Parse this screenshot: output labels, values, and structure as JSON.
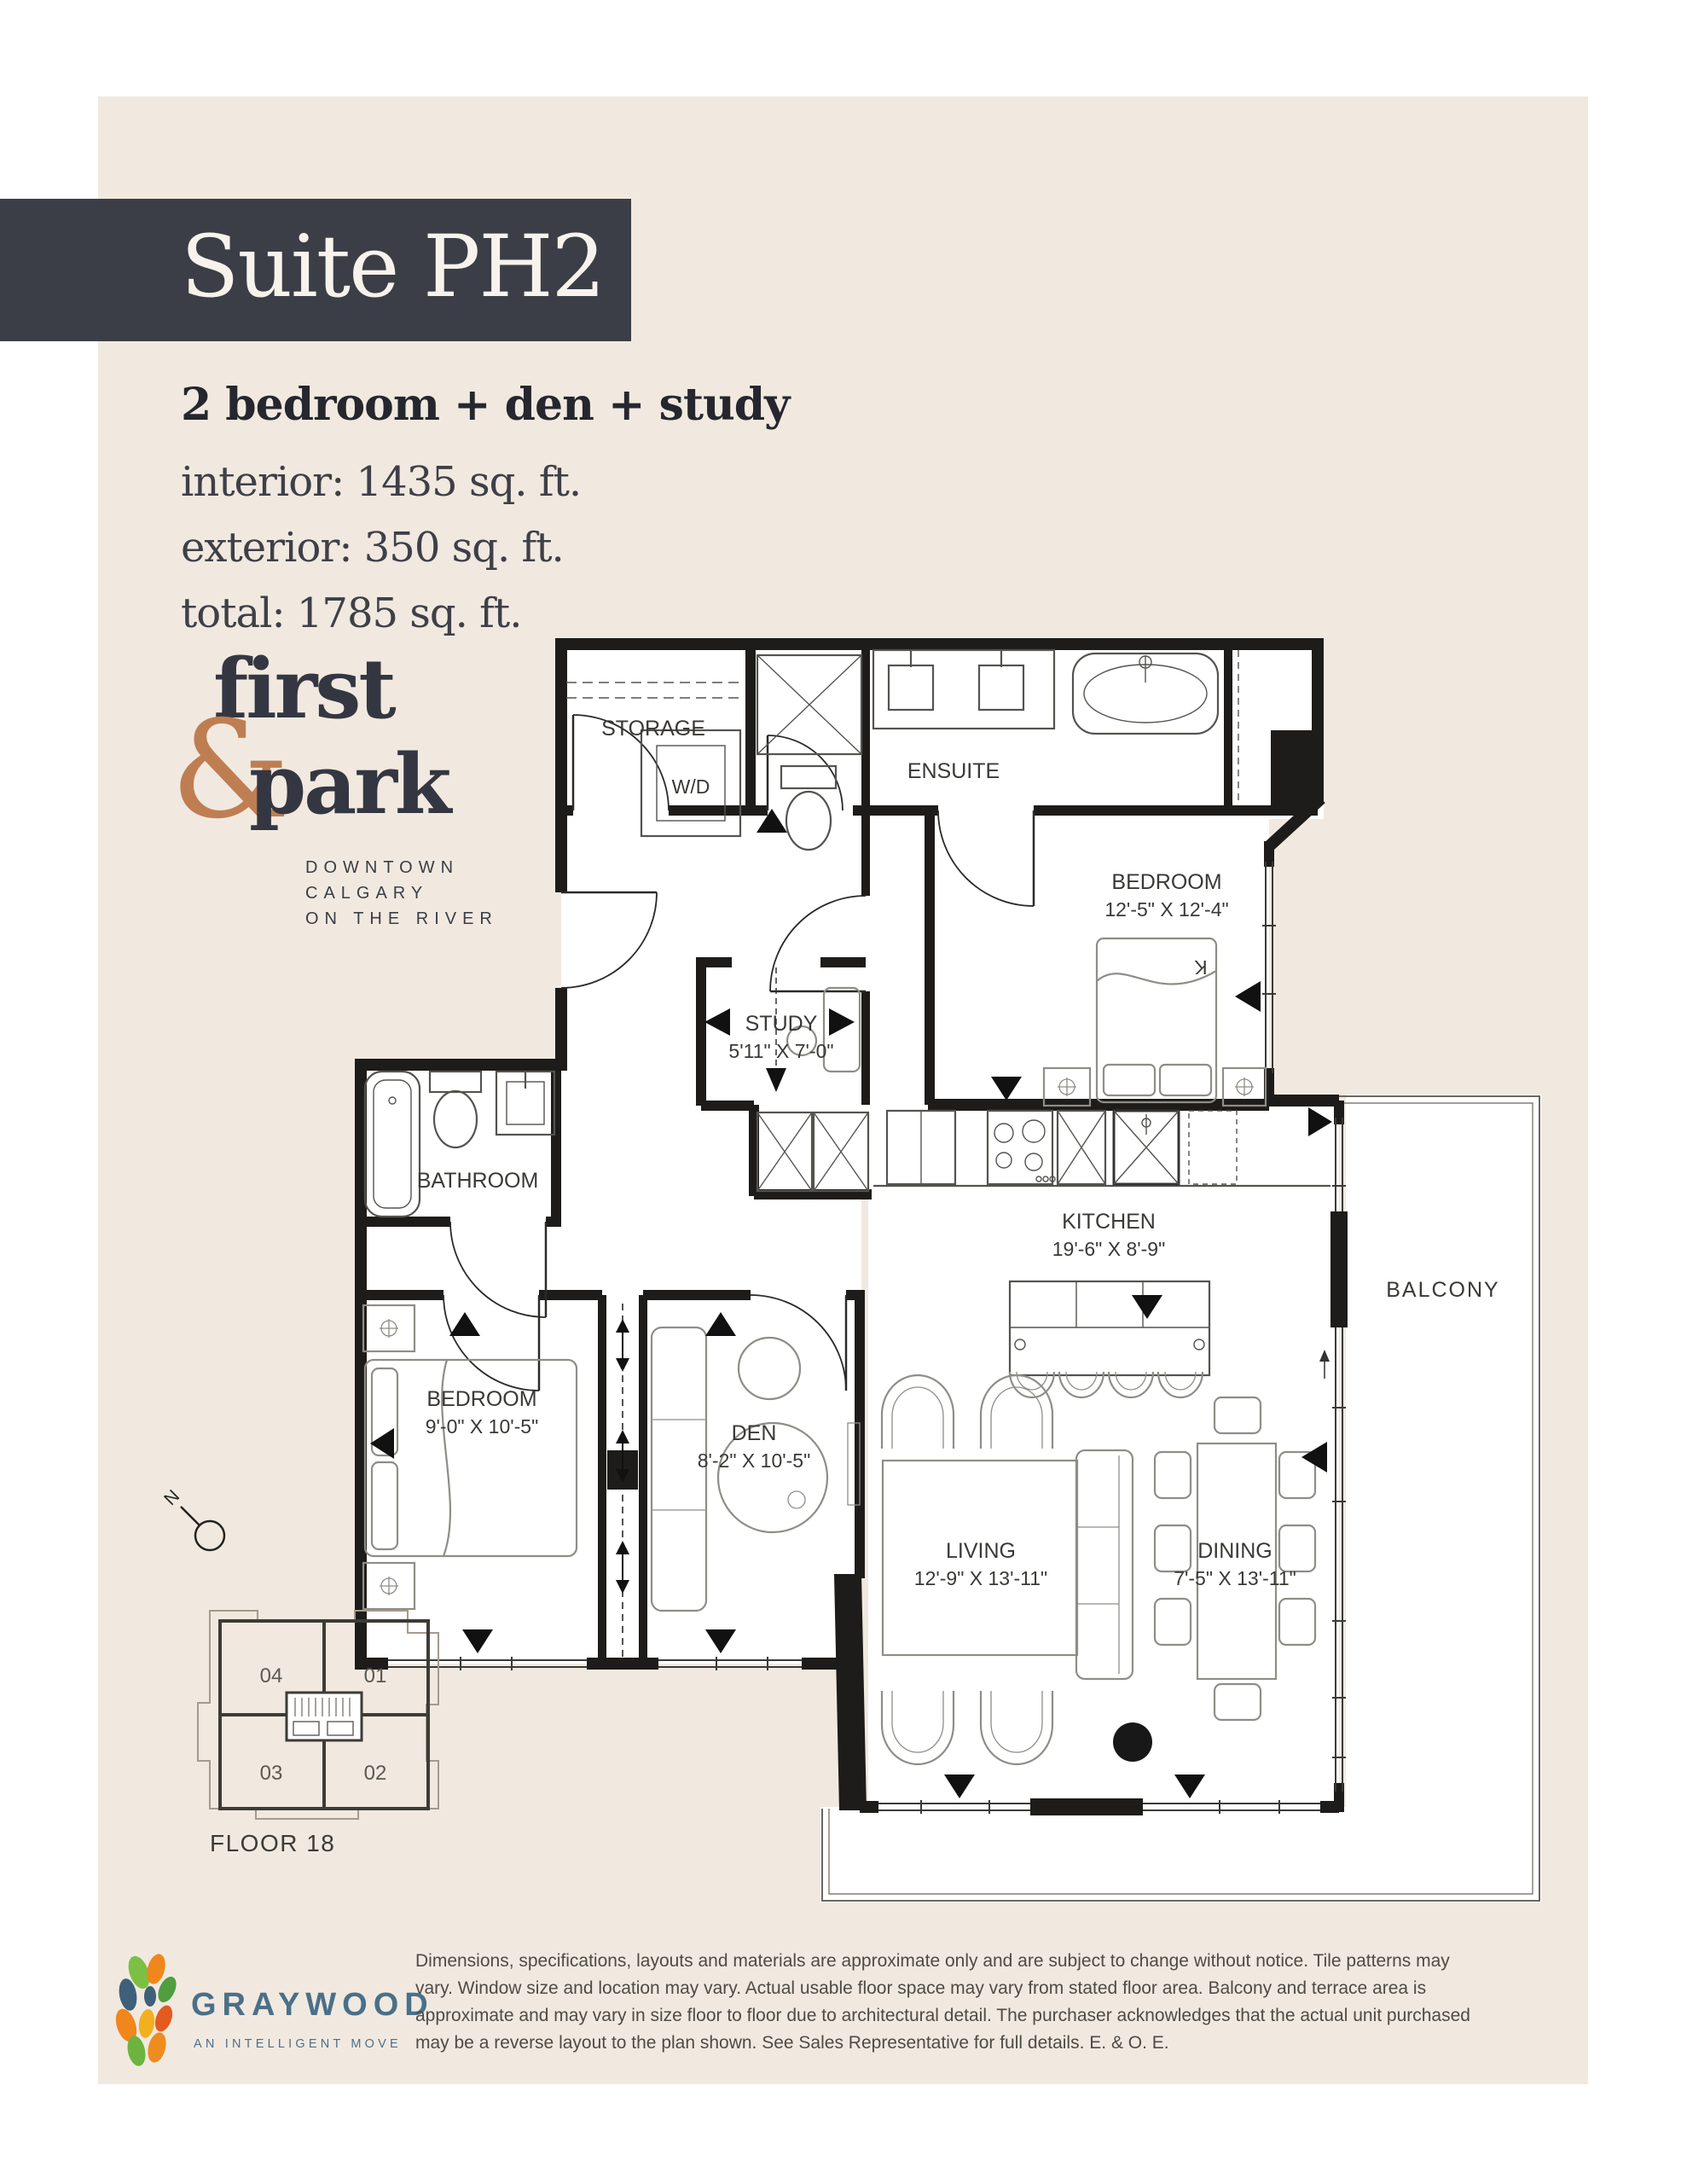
{
  "header": {
    "suite_title": "Suite PH2",
    "unit_type": "2 bedroom + den + study",
    "interior": "interior: 1435 sq. ft.",
    "exterior": "exterior: 350 sq. ft.",
    "total": "total: 1785 sq. ft."
  },
  "brand": {
    "word1": "first",
    "ampersand": "&",
    "word2": "park",
    "tagline_line1": "DOWNTOWN",
    "tagline_line2": "CALGARY",
    "tagline_line3": "ON THE RIVER"
  },
  "floorplan": {
    "rooms": [
      {
        "name": "BEDROOM",
        "dims": "12'-5\" X 12'-4\""
      },
      {
        "name": "STUDY",
        "dims": "5'11\" X 7'-0\""
      },
      {
        "name": "BATHROOM",
        "dims": ""
      },
      {
        "name": "BEDROOM",
        "dims": "9'-0\" X 10'-5\""
      },
      {
        "name": "DEN",
        "dims": "8'-2\" X 10'-5\""
      },
      {
        "name": "KITCHEN",
        "dims": "19'-6\" X 8'-9\""
      },
      {
        "name": "LIVING",
        "dims": "12'-9\" X 13'-11\""
      },
      {
        "name": "DINING",
        "dims": "7'-5\" X 13'-11\""
      }
    ],
    "fixtures": {
      "storage": "STORAGE",
      "wd": "W/D",
      "ensuite": "ENSUITE",
      "balcony": "BALCONY",
      "king_marker": "K"
    }
  },
  "keyplan": {
    "floor_label": "FLOOR 18",
    "units": [
      {
        "id": "04"
      },
      {
        "id": "01"
      },
      {
        "id": "03"
      },
      {
        "id": "02"
      }
    ],
    "north_marker": "N"
  },
  "developer": {
    "name": "GRAYWOOD",
    "tagline": "AN INTELLIGENT MOVE"
  },
  "disclaimer": "Dimensions, specifications, layouts and materials are approximate only and are subject to change without notice. Tile patterns may vary. Window size and location may vary. Actual usable floor space may vary from stated floor area. Balcony and terrace area is approximate and may vary in size floor to floor due to architectural detail. The purchaser acknowledges that the actual unit purchased may be a reverse layout to the plan shown. See Sales Representative for full details. E. & O. E.",
  "colors": {
    "page_background": "#f1e9e0",
    "title_band": "#3b3e46",
    "accent_copper": "#bf7e52",
    "developer_blue": "#4a7089",
    "wall_black": "#1d1c1a"
  }
}
